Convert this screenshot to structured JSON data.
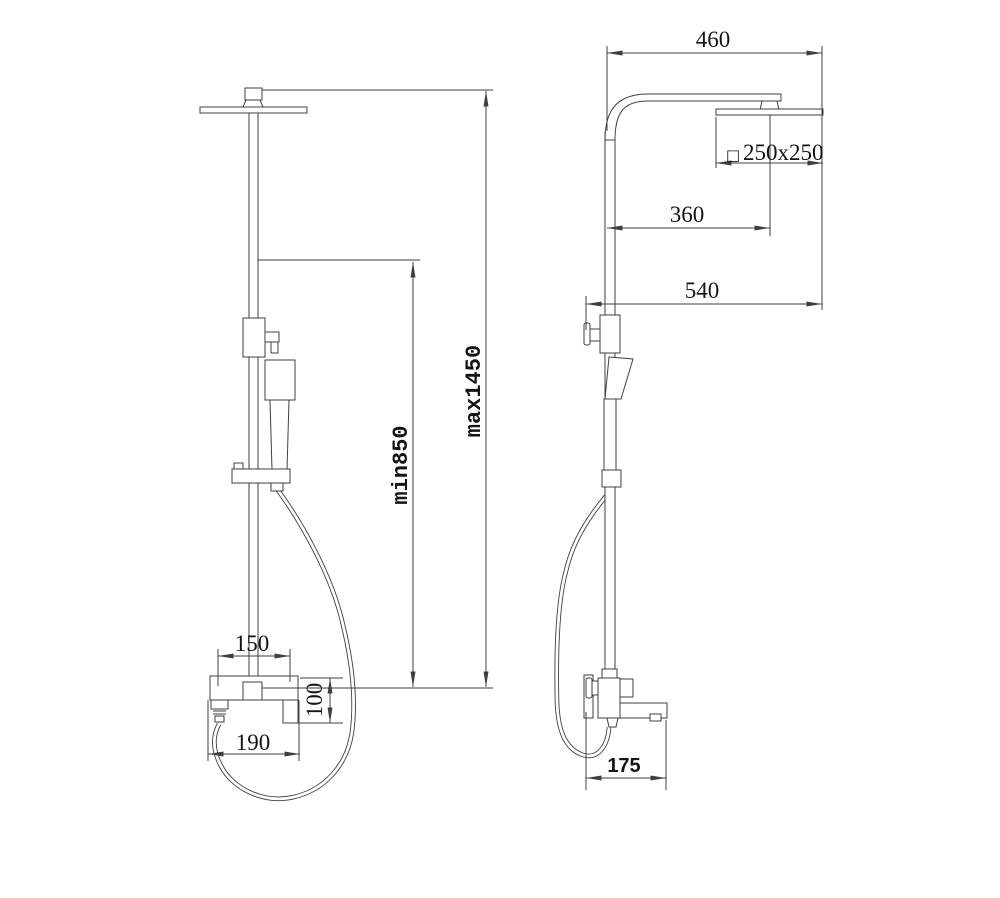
{
  "drawing": {
    "background_color": "#ffffff",
    "line_color": "#3f3f3f",
    "text_color": "#141414"
  },
  "dims": {
    "front": {
      "width_150": "150",
      "height_100": "100",
      "width_190": "190",
      "min_height": "min850",
      "max_height": "max1450"
    },
    "side": {
      "width_460": "460",
      "head_symbol": "□",
      "head_size": "250x250",
      "width_360": "360",
      "width_540": "540",
      "depth_175": "175"
    }
  }
}
